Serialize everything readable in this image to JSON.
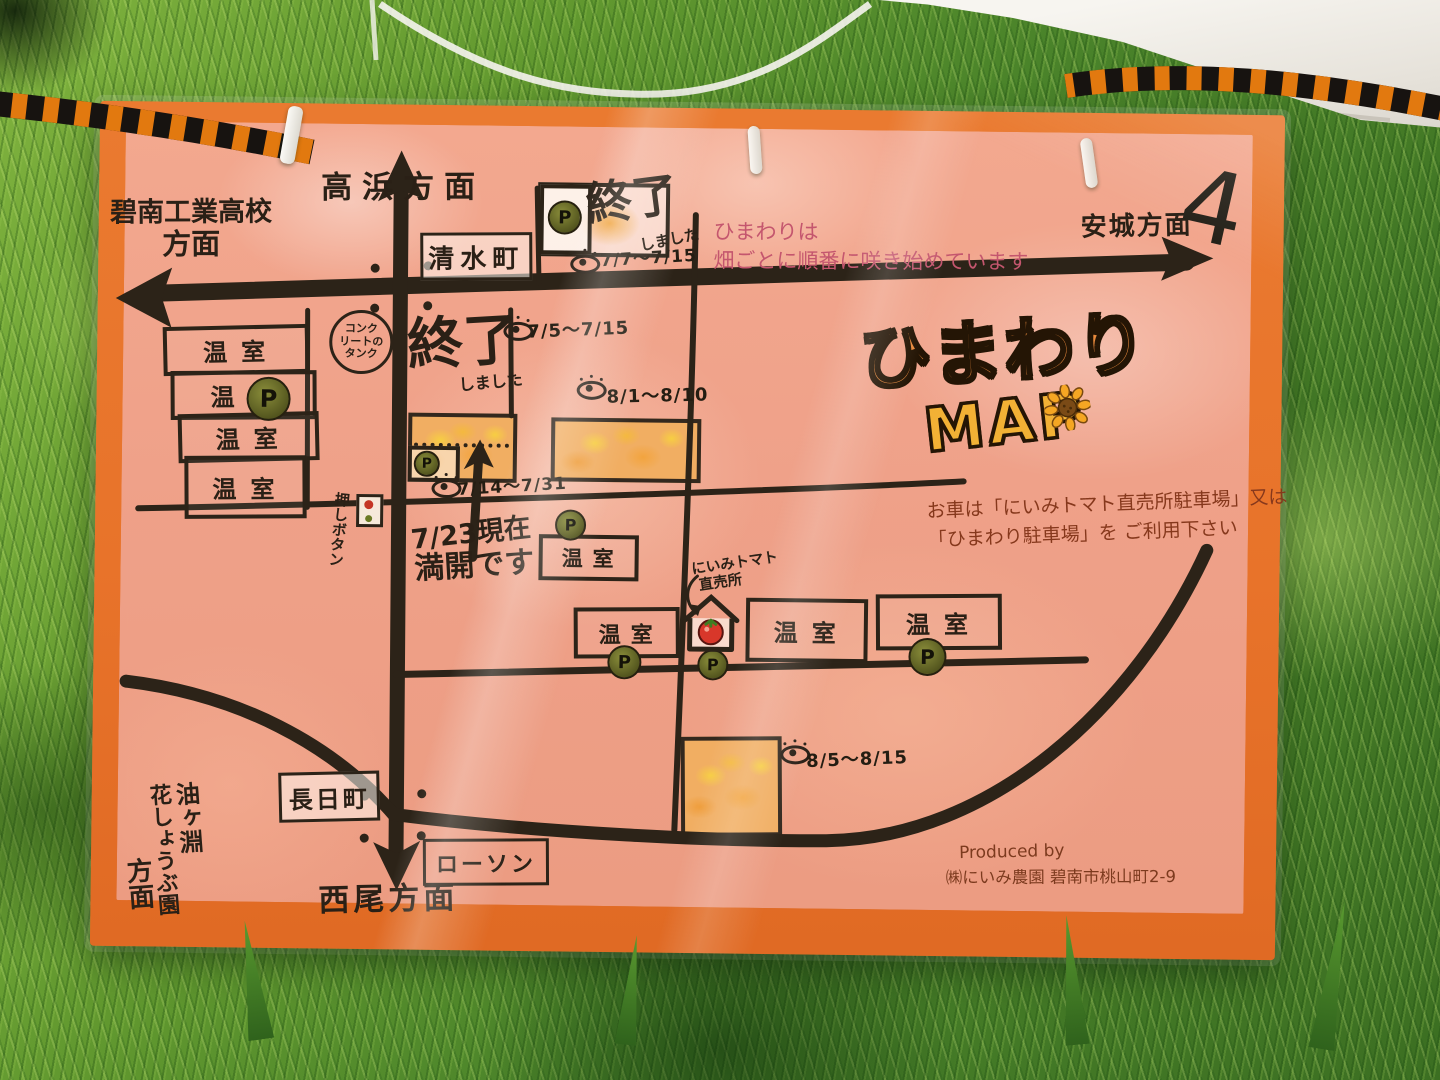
{
  "scene": {
    "setting": "hand-drawn sunflower map poster in plastic sleeve hung on rope over grass",
    "rope_colors": {
      "orange": "#e2790f",
      "black": "#171310"
    },
    "poster_border_color": "#e8732a",
    "paper_color": "#efa189",
    "road_color": "#2c2318"
  },
  "map": {
    "logo": {
      "title": "ひまわり",
      "subtitle": "MAP"
    },
    "directions": {
      "hekinan_line1": "碧南工業高校",
      "hekinan_line2": "方面",
      "takahama": "高浜方面",
      "anjo": "安城方面",
      "anjo_mark": "4",
      "nishio": "西尾方面",
      "aburagafuchi_col1": "油ヶ淵",
      "aburagafuchi_col2": "花しょうぶ園",
      "aburagafuchi_col3": "方面"
    },
    "signs": {
      "shimizu": "清水町",
      "nagahi": "長日町",
      "lawson": "ローソン"
    },
    "notes": {
      "bloom_line1": "ひまわりは",
      "bloom_line2": "畑ごとに順番に咲き始めています",
      "parking_line1": "お車は「にいみトマト直売所駐車場」又は",
      "parking_line2": "「ひまわり駐車場」を ご利用下さい",
      "mankai_line1": "7/23現在",
      "mankai_line2": "満開です",
      "ended_main": "終了",
      "ended_sub": "しました"
    },
    "labels": {
      "greenhouse": "温室",
      "parking": "P",
      "tank_line1": "コンク",
      "tank_line2": "リートの",
      "tank_line3": "タンク",
      "push_button": "押しボタン",
      "niimi_line1": "にいみトマト",
      "niimi_line2": "直売所"
    },
    "viewing_dates": {
      "field_top": "7/7〜7/15",
      "field_a": "7/5〜7/15",
      "field_b": "8/1〜8/10",
      "field_c": "7/14〜7/31",
      "field_d": "8/5〜8/15"
    },
    "credit": {
      "line1": "Produced by",
      "line2": "㈱にいみ農園 碧南市桃山町2-9"
    }
  }
}
